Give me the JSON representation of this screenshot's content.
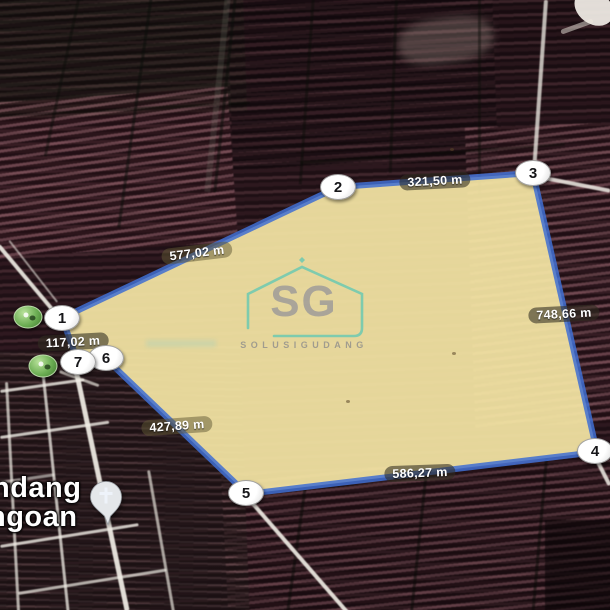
{
  "parcel": {
    "fill_color": "#f4e5a5",
    "stroke_color": "#3f6ed2",
    "vertex_markers": [
      {
        "label": "1"
      },
      {
        "label": "2"
      },
      {
        "label": "3"
      },
      {
        "label": "4"
      },
      {
        "label": "5"
      },
      {
        "label": "6"
      },
      {
        "label": "7"
      }
    ],
    "measurements": [
      {
        "value": "577,02 m",
        "edge": "1-2"
      },
      {
        "value": "321,50 m",
        "edge": "2-3"
      },
      {
        "value": "748,66 m",
        "edge": "3-4"
      },
      {
        "value": "586,27 m",
        "edge": "4-5"
      },
      {
        "value": "427,89 m",
        "edge": "5-6"
      },
      {
        "value": "117,02 m",
        "edge": "7-1"
      }
    ]
  },
  "map": {
    "place_label": {
      "line1": "ndang",
      "line2": "ngoan"
    },
    "poi": {
      "church_pin": "church-pin",
      "green_pins": 2
    }
  },
  "watermark": {
    "logo": "SG",
    "brand": "SOLUSIGUDANG",
    "accent_color": "#57c7b5",
    "letter_color": "#8e8e99"
  }
}
